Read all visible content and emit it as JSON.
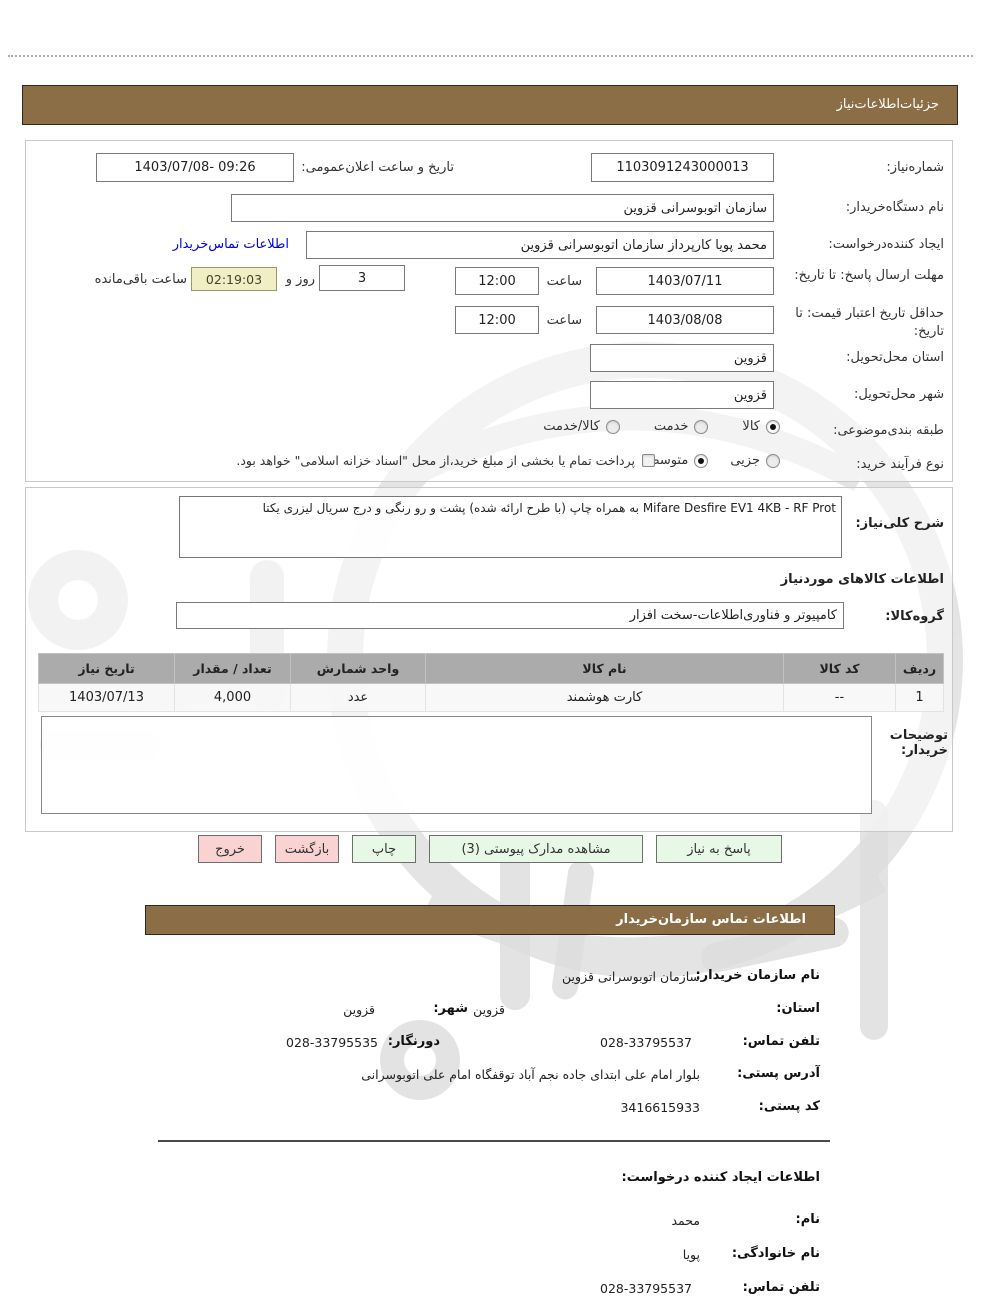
{
  "header": {
    "details_title": "جزئیات‌اطلاعات‌نیاز",
    "contact_title": "اطلاعات تماس سازمان‌خریدار"
  },
  "colors": {
    "accent_brown": "#8b6e46",
    "button_green": "#e7f8e7",
    "button_pink": "#f9d2d2",
    "link_blue": "#0000dd",
    "timer_bg": "#f0eec5",
    "table_header_gray": "#ababab"
  },
  "form": {
    "need_number": {
      "label": "شماره‌نیاز:",
      "value": "1103091243000013"
    },
    "announce": {
      "label": "تاریخ و ساعت اعلان‌عمومی:",
      "value": "1403/07/08- 09:26"
    },
    "buyer_org": {
      "label": "نام دستگاه‌خریدار:",
      "value": "سازمان اتوبوسرانی قزوین"
    },
    "creator": {
      "label": "ایجاد کننده‌درخواست:",
      "value": "محمد پویا کارپرداز سازمان اتوبوسرانی قزوین",
      "link_label": "اطلاعات تماس‌خریدار"
    },
    "deadline": {
      "label": "مهلت ارسال پاسخ: تا تاریخ:",
      "date": "1403/07/11",
      "time_label": "ساعت",
      "time": "12:00",
      "days": "3",
      "days_label": "روز و",
      "countdown": "02:19:03",
      "countdown_label": "ساعت باقی‌مانده"
    },
    "validity": {
      "label": "حداقل تاریخ اعتبار قیمت: تا تاریخ:",
      "date": "1403/08/08",
      "time_label": "ساعت",
      "time": "12:00"
    },
    "province": {
      "label": "استان محل‌تحویل:",
      "value": "قزوین"
    },
    "city": {
      "label": "شهر محل‌تحویل:",
      "value": "قزوین"
    },
    "category": {
      "label": "طبقه بندی‌موضوعی:",
      "selected": "کالا",
      "options": [
        {
          "label": "کالا",
          "selected": true
        },
        {
          "label": "خدمت",
          "selected": false
        },
        {
          "label": "کالا/خدمت",
          "selected": false
        }
      ]
    },
    "process": {
      "label": "نوع فرآیند خرید:",
      "selected": "متوسط",
      "options": [
        {
          "label": "جزیی",
          "selected": false
        },
        {
          "label": "متوسط",
          "selected": true
        }
      ],
      "checkbox_label": "پرداخت تمام یا بخشی از مبلغ خرید،از محل \"اسناد خزانه اسلامی\" خواهد بود.",
      "checkbox_checked": false
    }
  },
  "desc": {
    "label": "شرح کلی‌نیاز:",
    "value": "Mifare Desfire EV1 4KB - RF Prot به همراه چاپ (با طرح ارائه شده) پشت و رو رنگی و درج سریال لیزری یکتا"
  },
  "goods": {
    "heading": "اطلاعات کالاهای موردنیاز",
    "group": {
      "label": "گروه‌کالا:",
      "value": "کامپیوتر و فناوری‌اطلاعات-سخت افزار"
    },
    "table": {
      "headers": [
        "ردیف",
        "کد کالا",
        "نام کالا",
        "واحد شمارش",
        "تعداد / مقدار",
        "تاریخ نیاز"
      ],
      "rows": [
        [
          "1",
          "--",
          "کارت هوشمند",
          "عدد",
          "4,000",
          "1403/07/13"
        ]
      ]
    }
  },
  "notes": {
    "label": "توضیحات خریدار:",
    "value": ""
  },
  "buttons": [
    {
      "label": "پاسخ به نیاز",
      "style": "green"
    },
    {
      "label": "مشاهده مدارک پیوستی (3)",
      "style": "green"
    },
    {
      "label": "چاپ",
      "style": "green"
    },
    {
      "label": "بازگشت",
      "style": "pink"
    },
    {
      "label": "خروج",
      "style": "pink"
    }
  ],
  "contact": {
    "org": {
      "label": "نام سازمان خریدار:",
      "value": "سازمان اتوبوسرانی قزوین"
    },
    "province": {
      "label": "استان:",
      "value": "قزوین"
    },
    "city": {
      "label": "شهر:",
      "value": "قزوین"
    },
    "phone": {
      "label": "تلفن تماس:",
      "value": "028-33795537"
    },
    "fax": {
      "label": "دورنگار:",
      "value": "028-33795535"
    },
    "address": {
      "label": "آدرس پستی:",
      "value": "بلوار امام علی ابتدای جاده نجم آباد توقفگاه امام علی اتوبوسرانی"
    },
    "postal": {
      "label": "کد پستی:",
      "value": "3416615933"
    }
  },
  "creator_info": {
    "heading": "اطلاعات ایجاد کننده درخواست:",
    "first_name": {
      "label": "نام:",
      "value": "محمد"
    },
    "last_name": {
      "label": "نام خانوادگی:",
      "value": "پویا"
    },
    "phone": {
      "label": "تلفن تماس:",
      "value": "028-33795537"
    }
  }
}
